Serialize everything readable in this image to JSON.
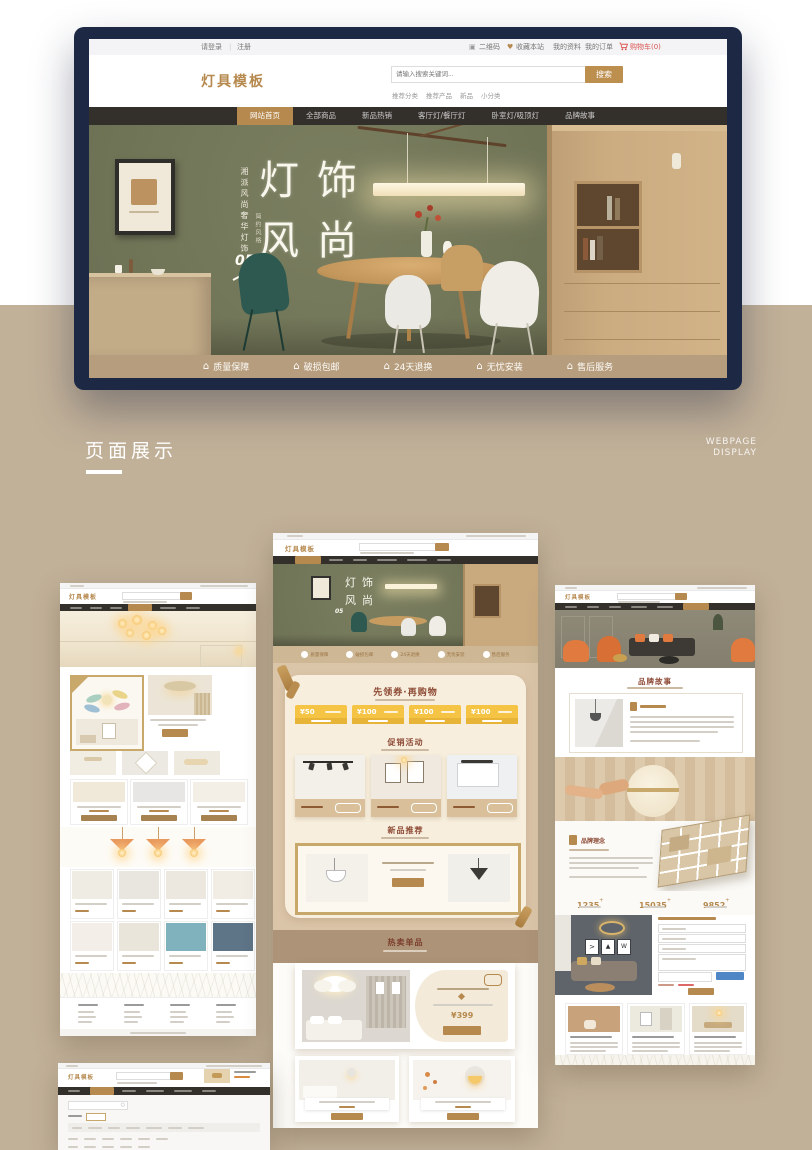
{
  "colors": {
    "accent_gold": "#b6894e",
    "frame_navy": "#1d2944",
    "background_tan": "#c2b199",
    "coupon_yellow": "#f5c445",
    "heading_brown_red": "#8d4a35",
    "cart_red": "#d9534f",
    "hero_olive_green": "#6f7356"
  },
  "site": {
    "topbar": {
      "login": "请登录",
      "register": "注册",
      "qrcode": "二维码",
      "favorite": "收藏本站",
      "profile": "我的资料",
      "orders": "我的订单",
      "cart": "购物车(0)"
    },
    "logo": "灯具模板",
    "search": {
      "placeholder": "请输入搜索关键词...",
      "button": "搜索"
    },
    "hot_links": [
      "推荐分类",
      "推荐产品",
      "新品",
      "小分类"
    ],
    "nav": [
      "网站首页",
      "全部商品",
      "新品热销",
      "客厅灯/餐厅灯",
      "卧室灯/吸顶灯",
      "品牌故事"
    ],
    "hero": {
      "title_chars": [
        "灯",
        "饰",
        "风",
        "尚"
      ],
      "side_text": "湘派风尚奢华灯饰",
      "side_sub": "简约风格",
      "index_number": "05"
    },
    "services": [
      "质量保障",
      "破损包邮",
      "24天退换",
      "无忧安装",
      "售后服务"
    ]
  },
  "showcase": {
    "title": "页面展示",
    "subtitle_line1": "WEBPAGE",
    "subtitle_line2": "DISPLAY"
  },
  "center_page": {
    "coupon_title": "先领券·再购物",
    "coupons": [
      "¥50",
      "¥100",
      "¥100",
      "¥100"
    ],
    "promo_title": "促销活动",
    "new_title": "新品推荐",
    "hot_title": "热卖单品",
    "featured_price": "¥399"
  },
  "right_page": {
    "story_title": "品牌故事",
    "concept_title": "品牌理念",
    "stats": [
      "1235",
      "15035",
      "9852"
    ],
    "stats_suffix": "+"
  }
}
